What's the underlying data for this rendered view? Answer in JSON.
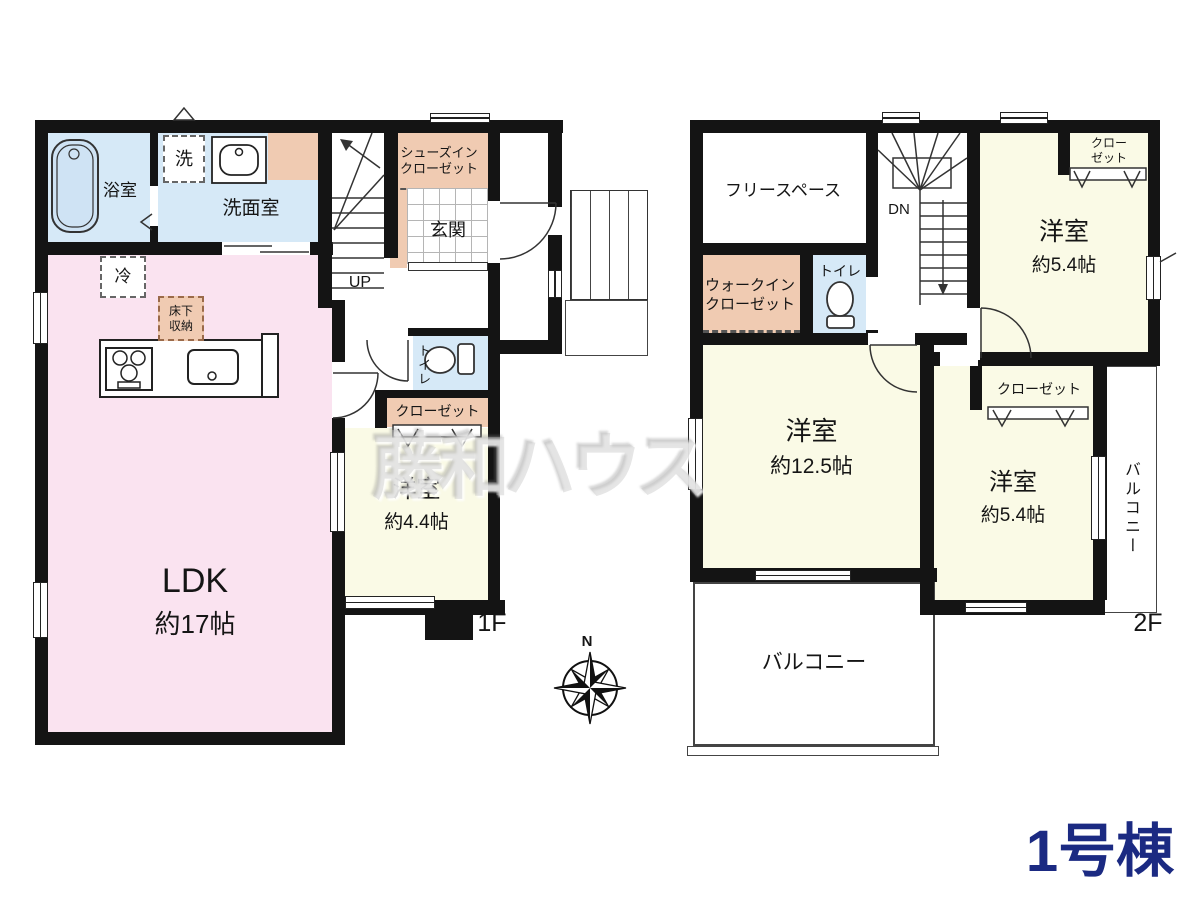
{
  "unit_label": "1号棟",
  "watermark": "藤和ハウス",
  "compass": {
    "north": "N"
  },
  "colors": {
    "wall": "#141414",
    "water_blue": "#d6e9f7",
    "ldk_pink": "#fae3f0",
    "room_cream": "#fafae6",
    "closet_peach": "#f0cbb2",
    "unit_navy": "#1b2a82"
  },
  "floor1": {
    "floor_label": "1F",
    "stairs": "UP",
    "bath": "浴室",
    "washer": "洗",
    "washroom": "洗面室",
    "shoes_closet_line1": "シューズイン",
    "shoes_closet_line2": "クローゼット",
    "entrance": "玄関",
    "fridge": "冷",
    "underfloor_line1": "床下",
    "underfloor_line2": "収納",
    "toilet": "トイレ",
    "closet": "クローゼット",
    "room44_name": "洋室",
    "room44_size": "約4.4帖",
    "ldk_name": "LDK",
    "ldk_size": "約17帖"
  },
  "floor2": {
    "floor_label": "2F",
    "stairs": "DN",
    "free_space": "フリースペース",
    "wic_line1": "ウォークイン",
    "wic_line2": "クローゼット",
    "toilet": "トイレ",
    "closet_top_line1": "クロー",
    "closet_top_line2": "ゼット",
    "room54a_name": "洋室",
    "room54a_size": "約5.4帖",
    "room125_name": "洋室",
    "room125_size": "約12.5帖",
    "closet_mid": "クローゼット",
    "room54b_name": "洋室",
    "room54b_size": "約5.4帖",
    "balcony_side": "バルコニー",
    "balcony_bottom": "バルコニー"
  }
}
